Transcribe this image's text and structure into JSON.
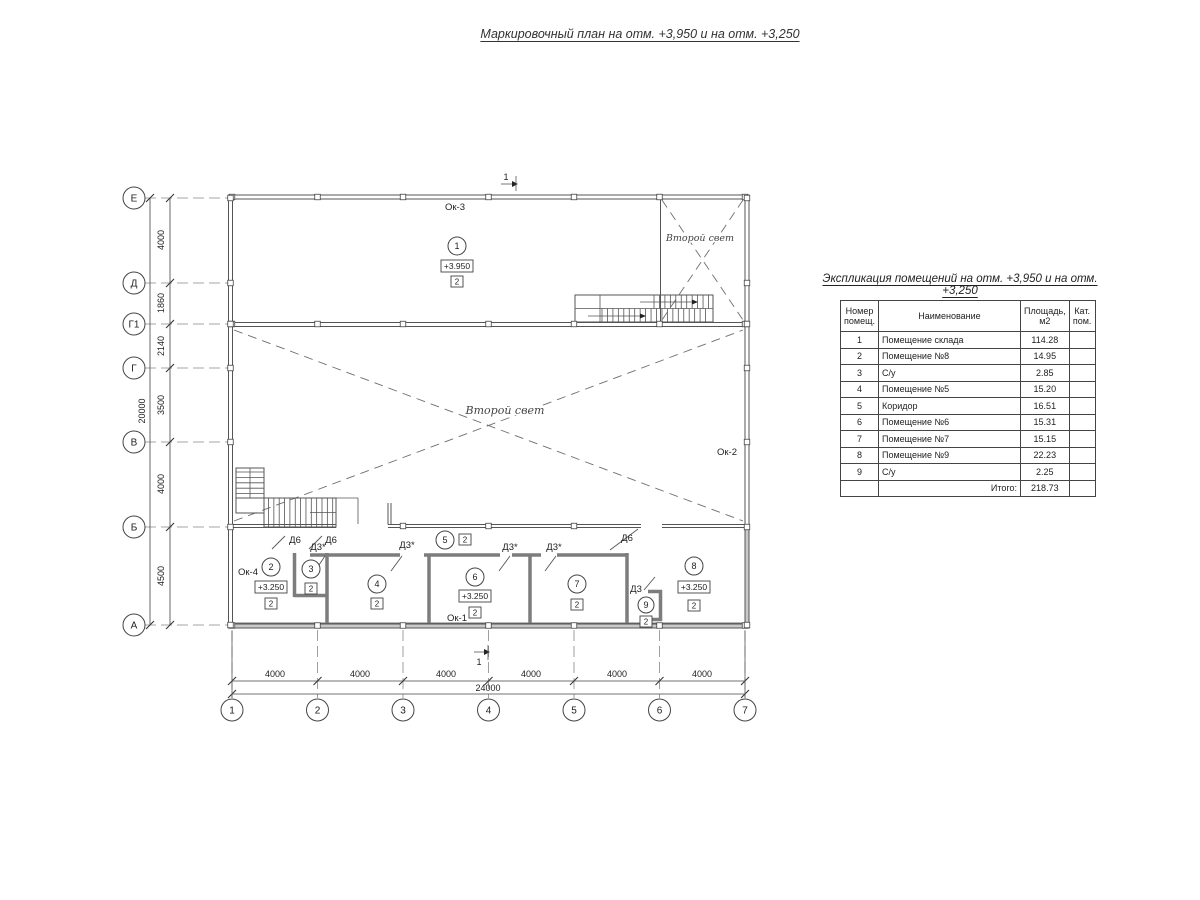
{
  "title": "Маркировочный план на отм. +3,950 и на отм. +3,250",
  "schedule": {
    "title": "Экспликация помещений на отм. +3,950 и на отм. +3,250",
    "headers": {
      "num": "Номер помещ.",
      "name": "Наименование",
      "area": "Площадь, м2",
      "cat": "Кат. пом."
    },
    "rows": [
      {
        "num": "1",
        "name": "Помещение склада",
        "area": "114.28",
        "cat": ""
      },
      {
        "num": "2",
        "name": "Помещение №8",
        "area": "14.95",
        "cat": ""
      },
      {
        "num": "3",
        "name": "С/у",
        "area": "2.85",
        "cat": ""
      },
      {
        "num": "4",
        "name": "Помещение №5",
        "area": "15.20",
        "cat": ""
      },
      {
        "num": "5",
        "name": "Коридор",
        "area": "16.51",
        "cat": ""
      },
      {
        "num": "6",
        "name": "Помещение №6",
        "area": "15.31",
        "cat": ""
      },
      {
        "num": "7",
        "name": "Помещение №7",
        "area": "15.15",
        "cat": ""
      },
      {
        "num": "8",
        "name": "Помещение №9",
        "area": "22.23",
        "cat": ""
      },
      {
        "num": "9",
        "name": "С/у",
        "area": "2.25",
        "cat": ""
      }
    ],
    "total_label": "Итого:",
    "total_area": "218.73"
  },
  "plan": {
    "row_axes": [
      "Е",
      "Д",
      "Г1",
      "Г",
      "В",
      "Б",
      "А"
    ],
    "col_axes": [
      "1",
      "2",
      "3",
      "4",
      "5",
      "6",
      "7"
    ],
    "left_dims": [
      "4000",
      "1860",
      "2140",
      "3500",
      "4000",
      "4500"
    ],
    "left_total": "20000",
    "bottom_dims": [
      "4000",
      "4000",
      "4000",
      "4000",
      "4000",
      "4000"
    ],
    "bottom_total": "24000",
    "windows": {
      "ok1": "Ок-1",
      "ok2": "Ок-2",
      "ok3": "Ок-3",
      "ok4": "Ок-4"
    },
    "second_light": "Второй свет",
    "doors": {
      "d6": "Д6",
      "d3s": "Д3*",
      "d3": "Д3"
    },
    "section_mark": "1",
    "rooms": {
      "r1": {
        "num": "1",
        "elev": "+3.950",
        "cat": "2"
      },
      "r2": {
        "num": "2",
        "elev": "+3.250",
        "cat": "2"
      },
      "r3": {
        "num": "3",
        "cat": "2"
      },
      "r4": {
        "num": "4",
        "cat": "2"
      },
      "r5": {
        "num": "5",
        "cat": "2"
      },
      "r6": {
        "num": "6",
        "elev": "+3.250",
        "cat": "2"
      },
      "r7": {
        "num": "7",
        "cat": "2"
      },
      "r8": {
        "num": "8",
        "elev": "+3.250",
        "cat": "2"
      },
      "r9": {
        "num": "9",
        "cat": "2"
      }
    }
  }
}
